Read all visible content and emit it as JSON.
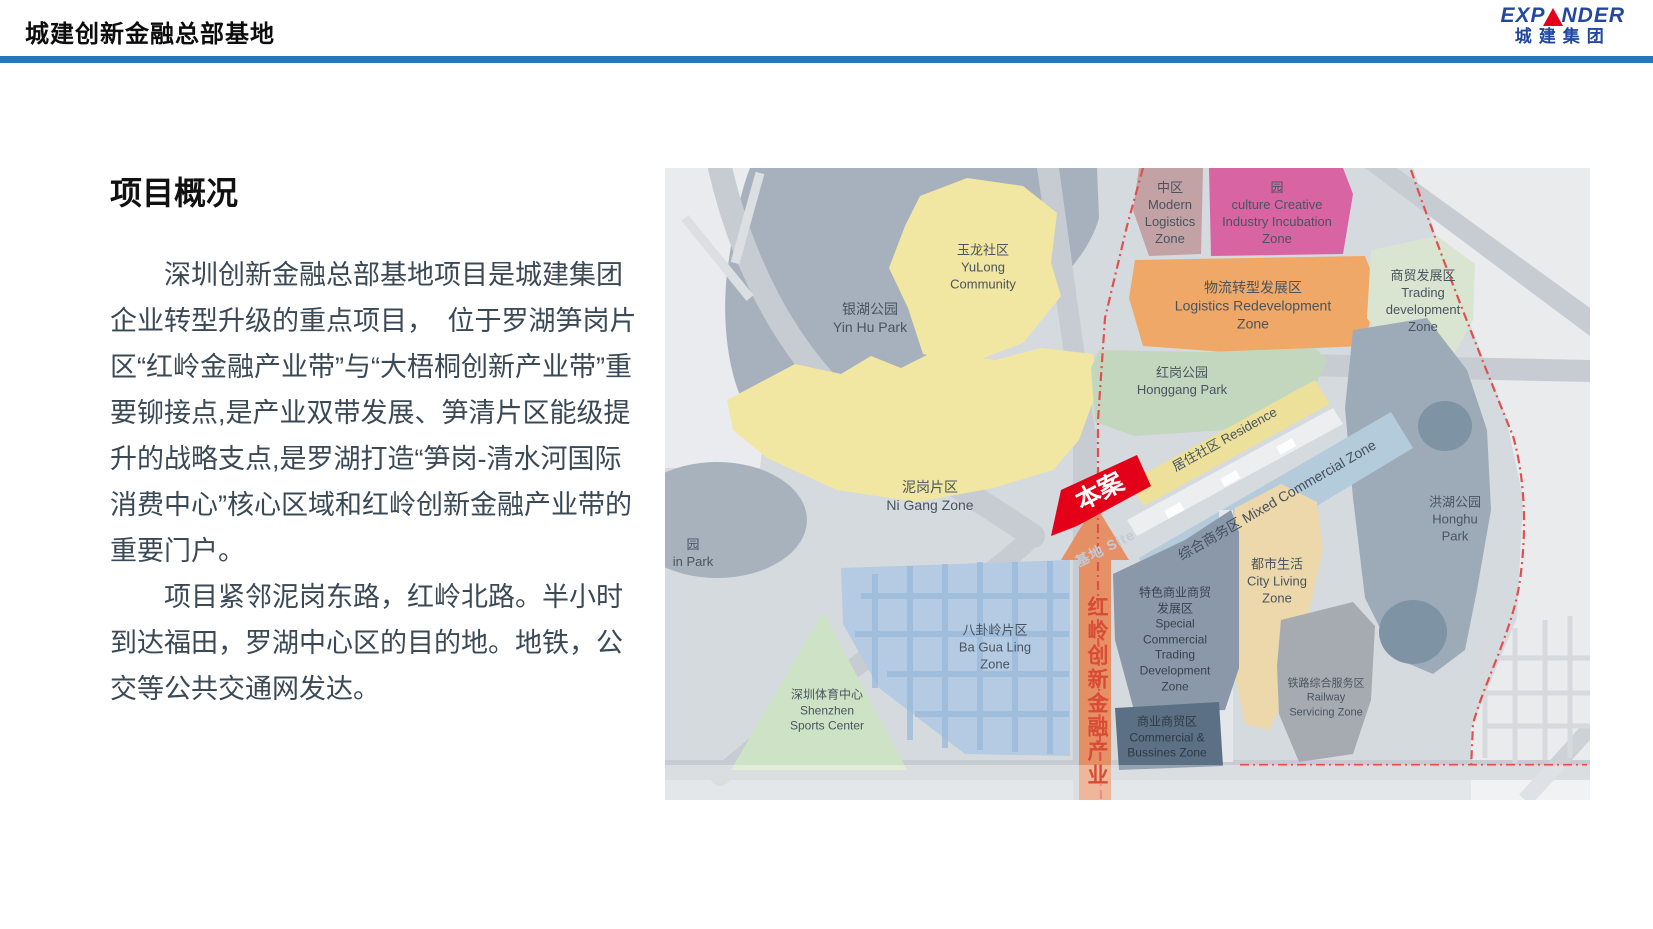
{
  "header": {
    "title": "城建创新金融总部基地",
    "logo": {
      "en_prefix": "EXP",
      "en_suffix": "NDER",
      "zh": "城建集团",
      "accent_blue": "#23479e",
      "accent_red": "#e3001b"
    },
    "rule_color": "#2478be"
  },
  "content": {
    "heading": "项目概况",
    "para1": "深圳创新金融总部基地项目是城建集团企业转型升级的重点项目，　位于罗湖笋岗片区“红岭金融产业带”与“大梧桐创新产业带”重要铆接点,是产业双带发展、笋清片区能级提升的战略支点,是罗湖打造“笋岗-清水河国际消费中心”核心区域和红岭创新金融产业带的重要门户。",
    "para2": "项目紧邻泥岗东路，红岭北路。半小时到达福田，罗湖中心区的目的地。地铁，公交等公共交通网发达。"
  },
  "map": {
    "zones": [
      {
        "id": "yinhu-park",
        "label": "银湖公园\nYin Hu Park",
        "color": "#a7b1bd"
      },
      {
        "id": "yulong-community",
        "label": "玉龙社区\nYuLong\nCommunity",
        "color": "#f2e7a2"
      },
      {
        "id": "nigang-zone",
        "label": "泥岗片区\nNi Gang Zone",
        "color": "#f2e7a2"
      },
      {
        "id": "modern-logistics",
        "label": "中区\nModern\nLogistics\nZone",
        "color": "#c2a2a4"
      },
      {
        "id": "culture-creative",
        "label": "园\nculture Creative\nIndustry Incubation\nZone",
        "color": "#d964a4"
      },
      {
        "id": "logistics-redev",
        "label": "物流转型发展区\nLogistics Redevelopment\nZone",
        "color": "#efa868"
      },
      {
        "id": "trading-development",
        "label": "商贸发展区\nTrading\ndevelopment\nZone",
        "color": "#d9e5d1"
      },
      {
        "id": "honggang-park",
        "label": "红岗公园\nHonggang Park",
        "color": "#c3d7bf"
      },
      {
        "id": "residence-band",
        "label": "居住社区 Residence",
        "color": "#ece09a"
      },
      {
        "id": "mixed-commercial",
        "label": "综合商务区 Mixed Commercial Zone",
        "color": "#b4cbdc"
      },
      {
        "id": "special-commercial",
        "label": "特色商业商贸\n发展区\nSpecial\nCommercial\nTrading\nDevelopment\nZone",
        "color": "#8a98aa"
      },
      {
        "id": "commercial-business",
        "label": "商业商贸区\nCommercial &\nBussines Zone",
        "color": "#5b7084"
      },
      {
        "id": "city-living",
        "label": "都市生活\nCity Living\nZone",
        "color": "#ecd8aa"
      },
      {
        "id": "railway-servicing",
        "label": "铁路综合服务区\nRailway\nServicing Zone",
        "color": "#a6abb2"
      },
      {
        "id": "honghu-park",
        "label": "洪湖公园\nHonghu\nPark",
        "color": "#9dabb9",
        "lake": "#7e93a4"
      },
      {
        "id": "bagualing-zone",
        "label": "八卦岭片区\nBa Gua Ling\nZone",
        "color": "#b4cbe3"
      },
      {
        "id": "sports-center",
        "label": "深圳体育中心\nShenzhen\nSports Center",
        "color": "#cee3c5"
      },
      {
        "id": "left-park-partial",
        "label": "园\nin Park",
        "color": "#a8b2bd"
      }
    ],
    "marker": {
      "label": "本案",
      "color": "#e50019"
    },
    "site_label": "基地 Site",
    "band": {
      "text": "红岭创新金融产业",
      "color": "#e78a5b",
      "text_color": "#d84b35"
    },
    "boundary_color": "#e0514e"
  }
}
